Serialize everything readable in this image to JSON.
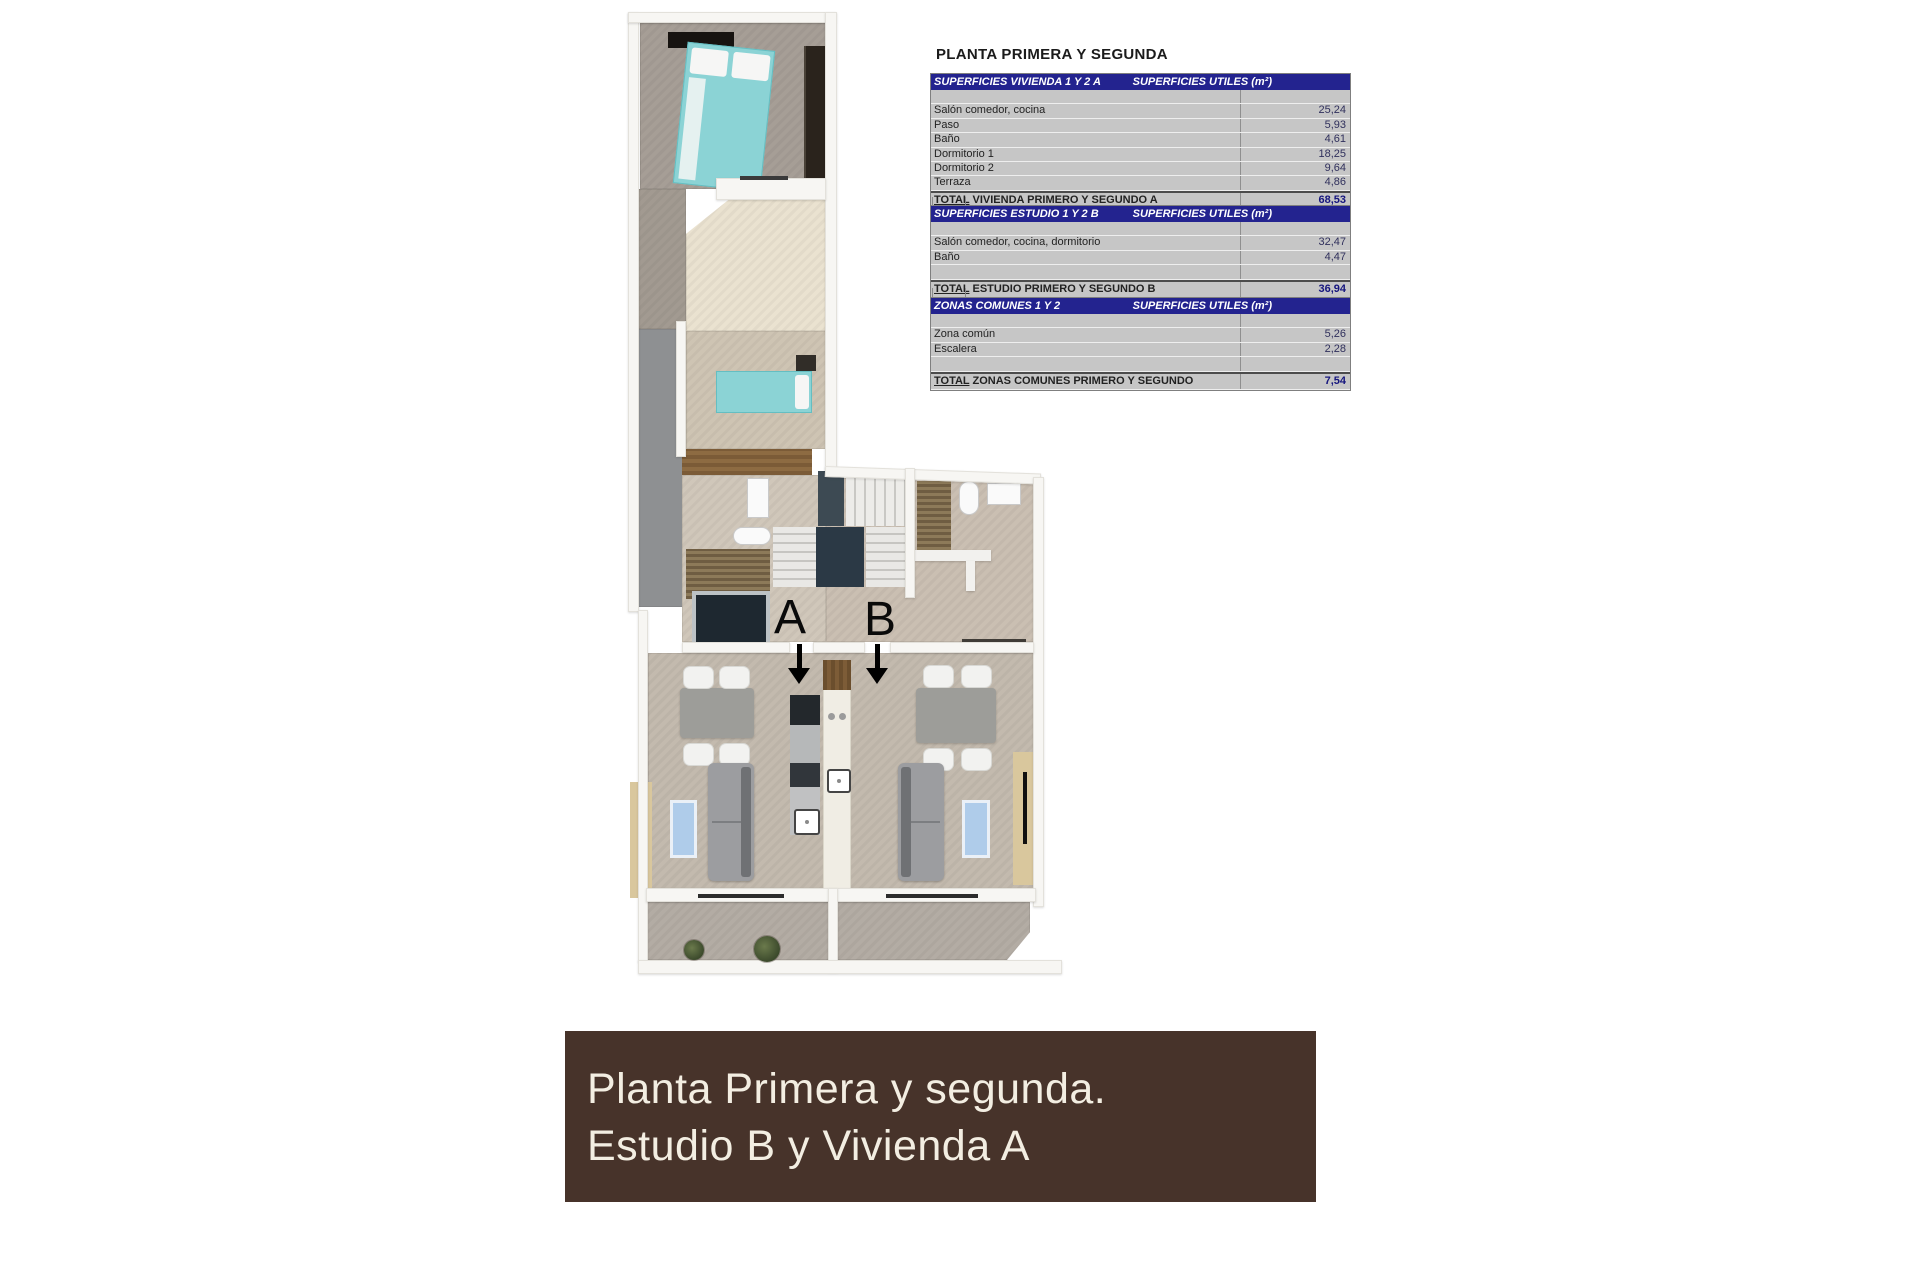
{
  "header": {
    "title": "PLANTA PRIMERA Y SEGUNDA"
  },
  "tables": [
    {
      "header_left": "SUPERFICIES VIVIENDA 1 Y 2 A",
      "header_right": "SUPERFICIES UTILES  (m²)",
      "rows": [
        {
          "label": "",
          "value": ""
        },
        {
          "label": "Salón comedor, cocina",
          "value": "25,24"
        },
        {
          "label": "Paso",
          "value": "5,93"
        },
        {
          "label": "Baño",
          "value": "4,61"
        },
        {
          "label": "Dormitorio 1",
          "value": "18,25"
        },
        {
          "label": "Dormitorio 2",
          "value": "9,64"
        },
        {
          "label": "Terraza",
          "value": "4,86"
        }
      ],
      "total": {
        "label": "TOTAL VIVIENDA PRIMERO Y SEGUNDO A",
        "value": "68,53"
      }
    },
    {
      "header_left": "SUPERFICIES ESTUDIO 1 Y 2 B",
      "header_right": "SUPERFICIES UTILES  (m²)",
      "rows": [
        {
          "label": "",
          "value": ""
        },
        {
          "label": "Salón comedor, cocina, dormitorio",
          "value": "32,47"
        },
        {
          "label": "Baño",
          "value": "4,47"
        },
        {
          "label": "",
          "value": ""
        }
      ],
      "total": {
        "label": "TOTAL ESTUDIO PRIMERO Y SEGUNDO B",
        "value": "36,94"
      }
    },
    {
      "header_left": "ZONAS COMUNES 1 Y 2",
      "header_right": "SUPERFICIES UTILES  (m²)",
      "rows": [
        {
          "label": "",
          "value": ""
        },
        {
          "label": "Zona común",
          "value": "5,26"
        },
        {
          "label": "Escalera",
          "value": "2,28"
        },
        {
          "label": "",
          "value": ""
        }
      ],
      "total": {
        "label": "TOTAL ZONAS COMUNES PRIMERO Y SEGUNDO",
        "value": "7,54"
      }
    }
  ],
  "floorplan": {
    "label_a": "A",
    "label_b": "B"
  },
  "banner": {
    "line1": "Planta Primera y segunda.",
    "line2": "Estudio B y Vivienda A"
  },
  "colors": {
    "table_header_blue": "#23238f",
    "table_body_gray": "#c6c6c6",
    "total_value_navy": "#15157e",
    "banner_brown": "#47332a",
    "banner_text": "#f3eee2",
    "bed_teal": "#8bd3d5",
    "floor_gray": "#a69e96",
    "floor_beige": "#cec4b3",
    "floor_cream": "#eae2d0",
    "floor_living": "#c3baae",
    "rug_blue": "#afccea",
    "wood_brown": "#7b5b37",
    "dark_furniture": "#1e2830"
  }
}
